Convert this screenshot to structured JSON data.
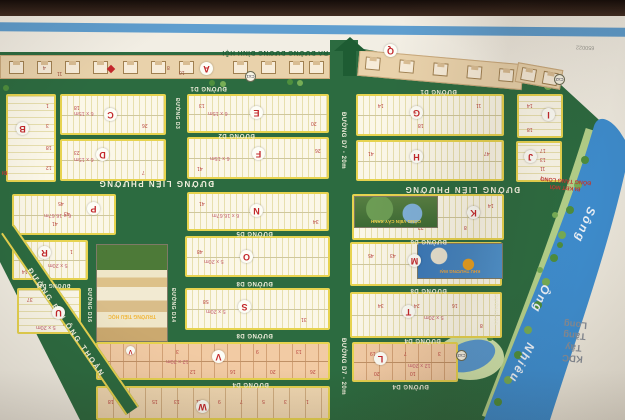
{
  "map": {
    "colors": {
      "road_green": "#2c6b40",
      "edge_yellow": "#e7d34f",
      "river_blue": "#3e8ed0",
      "paper": "#f1ede2",
      "block_letter_red": "#c3272b",
      "top_stripe_blue": "#5f9ecf"
    },
    "streets": {
      "d1": "ĐƯỜNG D1",
      "d2": "ĐƯỜNG D2",
      "d3": "ĐƯỜNG D3",
      "d4": "ĐƯỜNG D4",
      "d5": "ĐƯỜNG D5",
      "d6": "ĐƯỜNG D6",
      "d7": "ĐƯỜNG D7 - 20m",
      "d8": "ĐƯỜNG D8",
      "d9": "ĐƯỜNG D9",
      "d11": "ĐƯỜNG D11",
      "d14": "ĐƯỜNG D14",
      "d16": "ĐƯỜNG D16",
      "lien_phuong": "ĐƯỜNG LIÊN PHƯỜNG",
      "bui_ong_thoan": "ĐƯỜNG BÙI ÔNG THOẢN",
      "exit_top": "RA ĐƯỜNG DƯƠNG ĐÌNH HỘI"
    },
    "blocks": {
      "a": {
        "letter": "A",
        "dims": "",
        "numbers": []
      },
      "b": {
        "letter": "B",
        "dims": "",
        "numbers": [
          "1",
          "3",
          "18",
          "12"
        ]
      },
      "c": {
        "letter": "C",
        "dims": "6 x 15m",
        "numbers": [
          "18",
          "26"
        ]
      },
      "d": {
        "letter": "D",
        "dims": "6 x 15m",
        "numbers": [
          "23",
          "7"
        ]
      },
      "e": {
        "letter": "E",
        "dims": "6 x 15m",
        "numbers": [
          "13",
          "20"
        ]
      },
      "f": {
        "letter": "F",
        "dims": "6 x 15m",
        "numbers": [
          "41",
          "26"
        ]
      },
      "g": {
        "letter": "G",
        "dims": "",
        "numbers": [
          "11",
          "14",
          "18"
        ]
      },
      "h": {
        "letter": "H",
        "dims": "",
        "numbers": [
          "47",
          "41"
        ]
      },
      "i": {
        "letter": "I",
        "dims": "",
        "numbers": [
          "14",
          "18"
        ]
      },
      "j": {
        "letter": "J",
        "dims": "",
        "numbers": [
          "17",
          "13",
          "11",
          "7"
        ]
      },
      "k": {
        "letter": "K",
        "dims": "",
        "numbers": [
          "14",
          "8",
          "22"
        ]
      },
      "l": {
        "letter": "L",
        "dims": "12 x 20m",
        "numbers": [
          "19",
          "7",
          "3",
          "20",
          "10"
        ]
      },
      "m": {
        "letter": "M",
        "dims": "",
        "numbers": [
          "45",
          "43"
        ]
      },
      "n": {
        "letter": "N",
        "dims": "6 x 16.67m",
        "numbers": [
          "41",
          "34"
        ]
      },
      "o": {
        "letter": "O",
        "dims": "5 x 20m",
        "numbers": [
          "48"
        ]
      },
      "p": {
        "letter": "P",
        "dims": "6 x 16.67m",
        "numbers": [
          "45",
          "43",
          "41"
        ]
      },
      "q": {
        "letter": "Q",
        "dims": "",
        "numbers": []
      },
      "r": {
        "letter": "R",
        "dims": "5 x 20m",
        "numbers": [
          "1",
          "14"
        ]
      },
      "s": {
        "letter": "S",
        "dims": "5 x 20m",
        "numbers": [
          "58",
          "31"
        ]
      },
      "t": {
        "letter": "T",
        "dims": "5 x 20m",
        "numbers": [
          "34",
          "24",
          "16",
          "8"
        ]
      },
      "u": {
        "letter": "U",
        "dims": "5 x 20m",
        "numbers": [
          "37",
          "13",
          "11",
          "9"
        ]
      },
      "v": {
        "letter": "V",
        "dims": "12 x 20m",
        "numbers": [
          "13",
          "9",
          "5",
          "3",
          "26",
          "20",
          "16",
          "12"
        ]
      },
      "w": {
        "letter": "W",
        "dims": "",
        "numbers": [
          "18",
          "17",
          "15",
          "13",
          "11",
          "9",
          "7",
          "5",
          "3",
          "1"
        ]
      }
    },
    "houses": {
      "numbers": [
        "4",
        "11",
        "8",
        "10"
      ]
    },
    "landmarks": {
      "river": {
        "word1": "Sông",
        "word2": "Ông",
        "word3": "Nhiêu"
      },
      "neighbor": {
        "line1": "KDC",
        "line2": "Tây",
        "line3": "Tăng",
        "line4": "Long"
      },
      "kdt_sign": {
        "line1": "ĐI KĐT MỚI",
        "line2": "ĐÔNG TĂNG LONG"
      },
      "corner_code": "650022",
      "di_note": "ĐI",
      "markers": {
        "cx1": "Cx1",
        "cx2": "Cx2",
        "cx3": "Cx3"
      }
    },
    "insets": {
      "school_caption": "TRƯỜNG TIỂU HỌC",
      "park_caption": "CÔNG VIÊN CÂY XANH",
      "plaza_caption": "KHU THƯƠNG MẠI"
    }
  }
}
